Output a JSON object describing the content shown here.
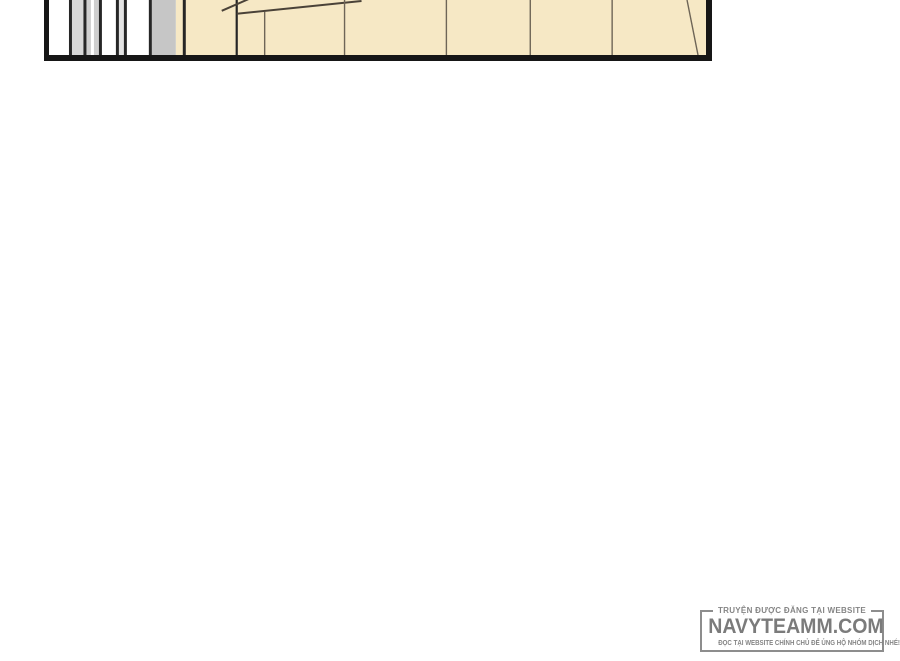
{
  "page": {
    "width": 900,
    "height": 661,
    "background_color": "#ffffff"
  },
  "comic_panel": {
    "description": "bottom edge of a comic panel: striped sliding door on the left, tan wooden wall paneling with seams and perspective lines on the right",
    "border_color": "#161616",
    "wood_color": "#f6e8c5",
    "wood_seam_color": "#6e6557",
    "door_line_color": "#262626",
    "door_gray_1": "#d8d8d8",
    "door_gray_2": "#cfcfcf",
    "door_gray_3": "#c6c6c6",
    "door_gray_4": "#e3e3e3"
  },
  "watermark": {
    "top_label": "TRUYỆN ĐƯỢC ĐĂNG TẠI WEBSITE",
    "site_name": "NAVYTEAMM.COM",
    "bottom_label": "ĐỌC TẠI WEBSITE CHÍNH CHỦ ĐỂ ỦNG HỘ NHÓM DỊCH NHÉ!",
    "text_color": "#858585",
    "site_color": "#7b7b7b",
    "border_color": "#8d8d8d"
  }
}
